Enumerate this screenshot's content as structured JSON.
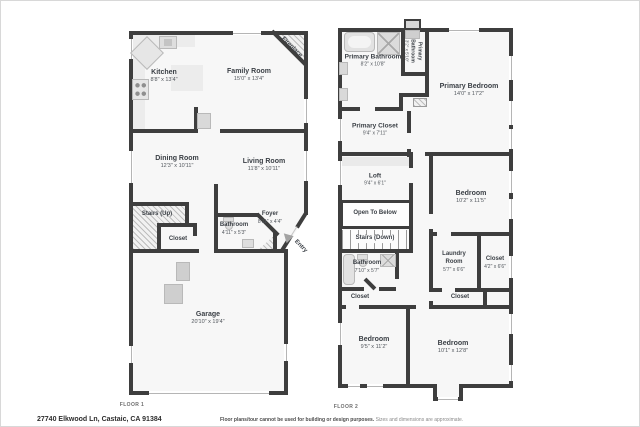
{
  "footer": {
    "address": "27740 Elkwood Ln, Castaic, CA 91384",
    "disclaimer_main": "Floor plans/tour cannot be used for building or design purposes.",
    "disclaimer_sub": "Sizes and dimensions are approximate."
  },
  "floor1": {
    "label": "FLOOR 1",
    "rooms": {
      "kitchen": {
        "name": "Kitchen",
        "dims": "8'8\" x 13'4\""
      },
      "family_room": {
        "name": "Family Room",
        "dims": "15'0\" x 13'4\""
      },
      "dining_room": {
        "name": "Dining Room",
        "dims": "12'3\" x 10'11\""
      },
      "living_room": {
        "name": "Living Room",
        "dims": "11'8\" x 10'11\""
      },
      "stairs_up": {
        "name": "Stairs (Up)"
      },
      "closet": {
        "name": "Closet"
      },
      "bathroom": {
        "name": "Bathroom",
        "dims": "4'11\" x 5'3\""
      },
      "foyer": {
        "name": "Foyer",
        "dims": "8'11\" x 4'4\""
      },
      "garage": {
        "name": "Garage",
        "dims": "20'10\" x 19'4\""
      },
      "fireplace": {
        "name": "Fireplace"
      },
      "entry": {
        "name": "Entry"
      }
    }
  },
  "floor2": {
    "label": "FLOOR 2",
    "rooms": {
      "primary_bathroom": {
        "name": "Primary Bathroom",
        "dims": "8'2\" x 10'8\""
      },
      "primary_bathroom_small": {
        "name": "Primary Bathroom",
        "dims": "3'2\" x 5'10\""
      },
      "primary_bedroom": {
        "name": "Primary Bedroom",
        "dims": "14'0\" x 17'2\""
      },
      "primary_closet": {
        "name": "Primary Closet",
        "dims": "9'4\" x 7'11\""
      },
      "loft": {
        "name": "Loft",
        "dims": "9'4\" x 6'1\""
      },
      "open_to_below": {
        "name": "Open To Below"
      },
      "stairs_down": {
        "name": "Stairs (Down)"
      },
      "bedroom_mid": {
        "name": "Bedroom",
        "dims": "10'2\" x 11'5\""
      },
      "bathroom": {
        "name": "Bathroom",
        "dims": "7'10\" x 5'7\""
      },
      "laundry_room": {
        "name": "Laundry Room",
        "dims": "5'7\" x 6'6\""
      },
      "closet_right": {
        "name": "Closet",
        "dims": "4'2\" x 6'6\""
      },
      "closet_left": {
        "name": "Closet"
      },
      "closet_mid": {
        "name": "Closet"
      },
      "bedroom_bl": {
        "name": "Bedroom",
        "dims": "9'5\" x 11'2\""
      },
      "bedroom_br": {
        "name": "Bedroom",
        "dims": "10'1\" x 12'8\""
      }
    }
  },
  "colors": {
    "wall": "#3e3e3e",
    "floor": "#f7f7f7",
    "hatch_line": "#bdbdbd",
    "fixture": "#dedede"
  }
}
